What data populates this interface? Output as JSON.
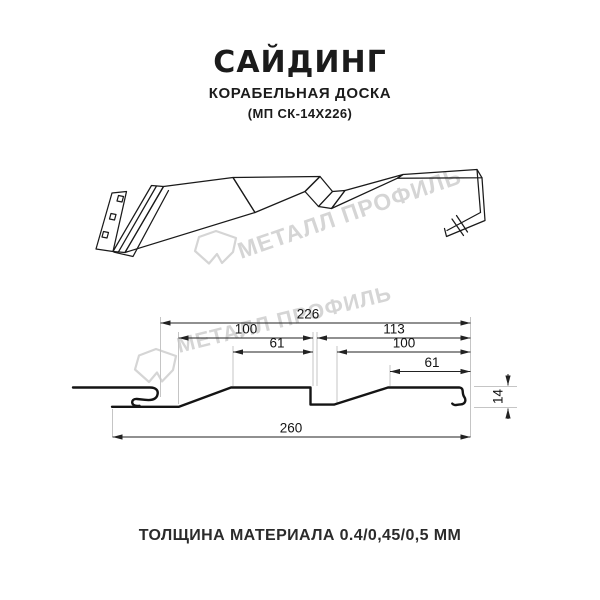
{
  "header": {
    "title": "САЙДИНГ",
    "subtitle": "КОРАБЕЛЬНАЯ ДОСКА",
    "model": "(МП СК-14Х226)"
  },
  "watermark": {
    "text": "МЕТАЛЛ ПРОФИЛЬ",
    "color": "#d5d5d5"
  },
  "drawing": {
    "type": "technical-cross-section",
    "dims": {
      "d_cover": "226",
      "d_left_100": "100",
      "d_right_113": "113",
      "d_left_61": "61",
      "d_right_100": "100",
      "d_right_61": "61",
      "d_height_14": "14",
      "d_total_260": "260"
    }
  },
  "footer": {
    "thickness": "ТОЛЩИНА МАТЕРИАЛА 0.4/0,45/0,5 ММ"
  },
  "colors": {
    "line": "#1a1a1a",
    "dim_line": "#222222",
    "extension_line": "#c5c5c5",
    "background": "#ffffff"
  }
}
